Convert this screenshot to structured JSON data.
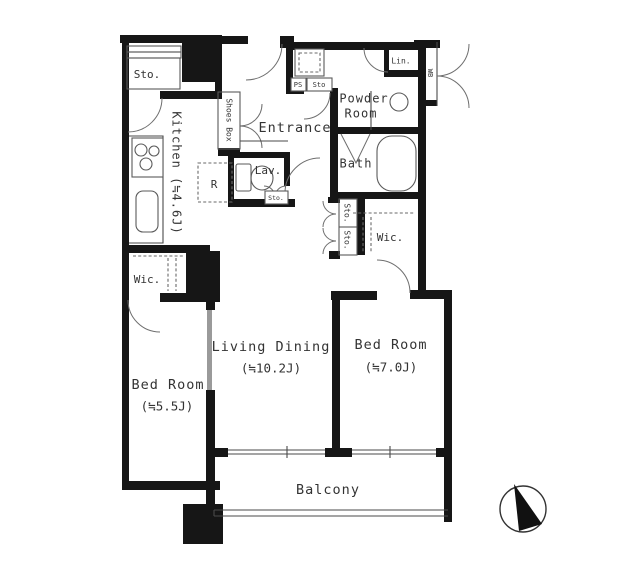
{
  "floorplan": {
    "rooms": {
      "living_dining": {
        "name": "Living Dining",
        "size": "(≒10.2J)"
      },
      "bedroom_right": {
        "name": "Bed Room",
        "size": "(≒7.0J)"
      },
      "bedroom_left": {
        "name": "Bed Room",
        "size": "(≒5.5J)"
      },
      "kitchen": {
        "label": "Kitchen (≒4.6J)"
      },
      "entrance": {
        "label": "Entrance"
      },
      "powder_room": {
        "line1": "Powder",
        "line2": "Room"
      },
      "bath": {
        "label": "Bath"
      },
      "lavatory": {
        "label": "Lav."
      },
      "balcony": {
        "label": "Balcony"
      }
    },
    "closets": {
      "storage_top_left": "Sto.",
      "shoes_box": "Shoes Box",
      "refrigerator": "R",
      "pipe_space": "PS",
      "storage_powder": "Sto",
      "linen": "Lin.",
      "wall_box": "WB",
      "storage_lav": "Sto.",
      "storage_hall_upper": "Sto.",
      "storage_hall_lower": "Sto.",
      "wic_right": "Wic.",
      "wic_left": "Wic."
    },
    "colors": {
      "wall": "#161616",
      "line": "#555555",
      "text": "#333333",
      "background": "#ffffff"
    }
  }
}
